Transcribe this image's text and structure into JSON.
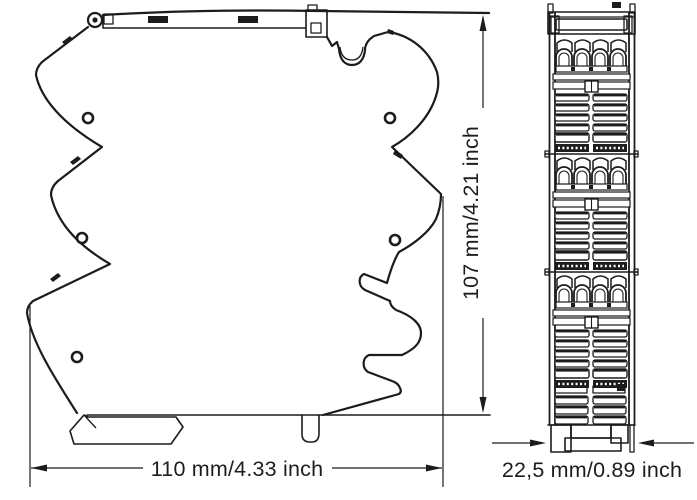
{
  "drawing": {
    "background_color": "#ffffff",
    "line_color": "#1c1c1c",
    "labels": {
      "width_dimension": "110 mm/4.33 inch",
      "height_dimension": "107 mm/4.21 inch",
      "depth_dimension": "22,5 mm/0.89 inch"
    }
  }
}
